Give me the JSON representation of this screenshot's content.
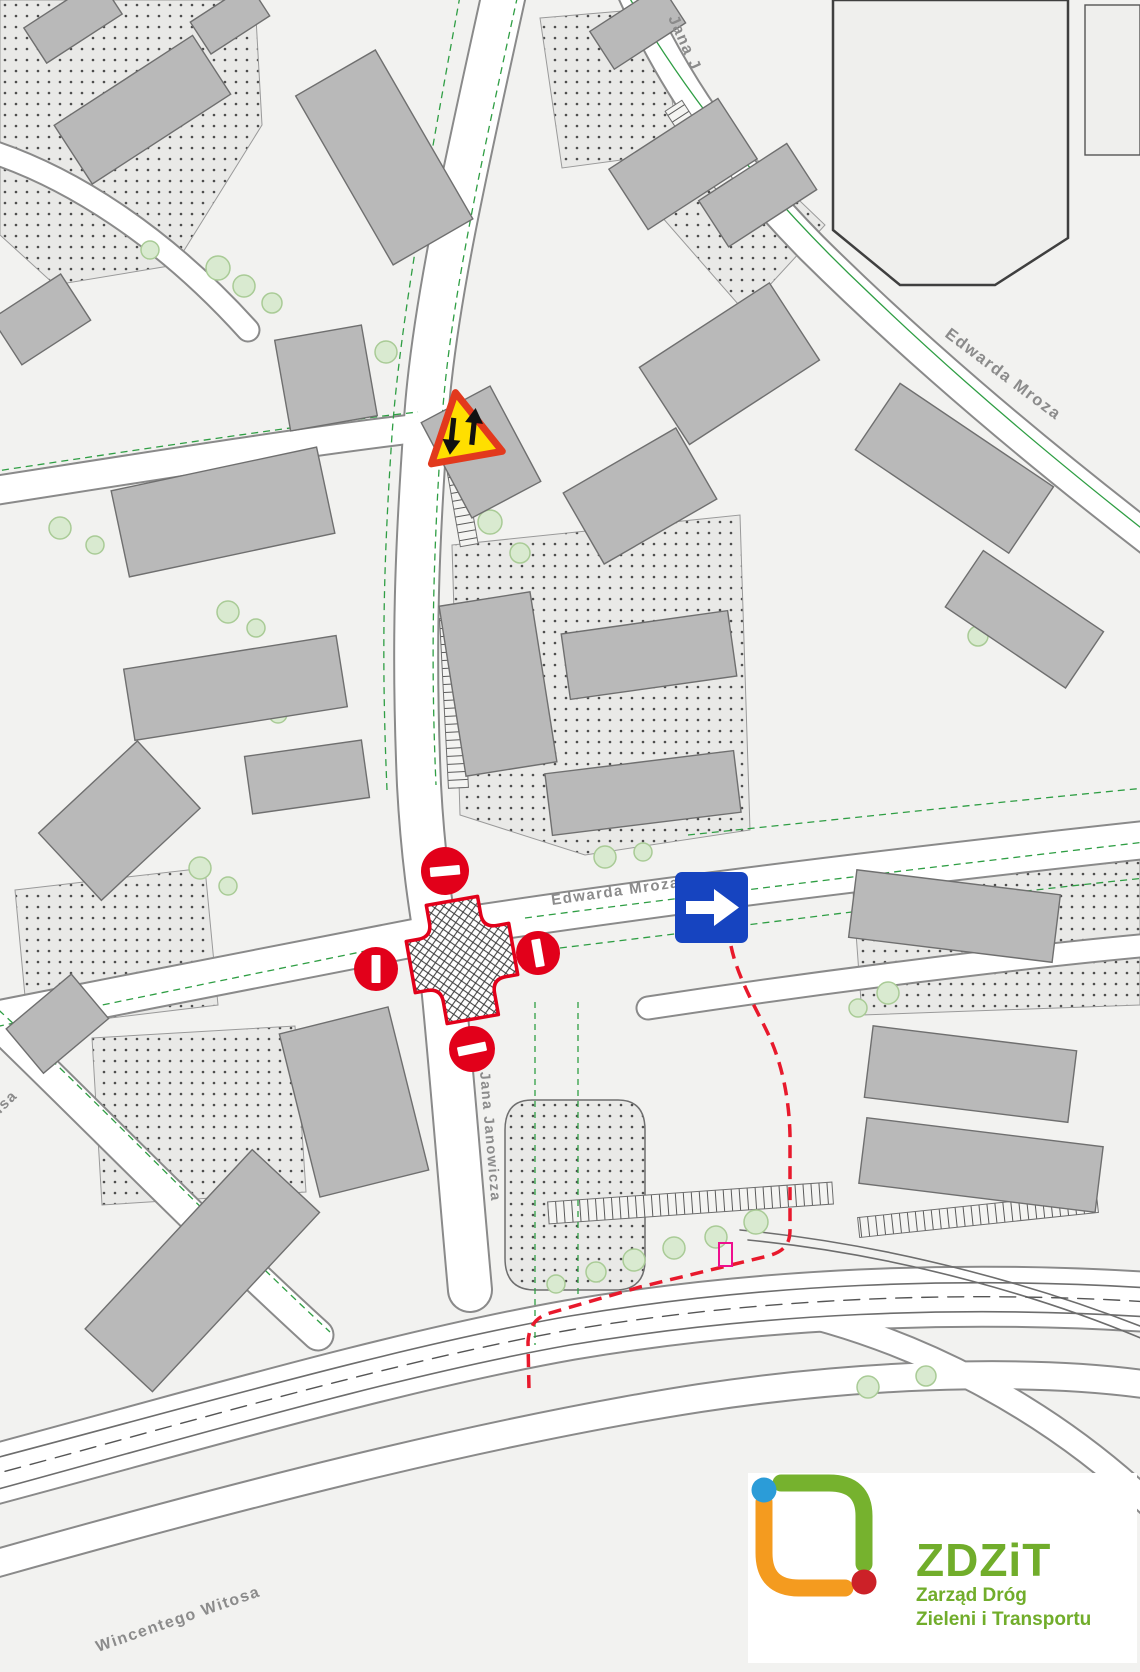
{
  "map": {
    "street_labels": [
      {
        "name": "jana-janowicza-north",
        "text": "Jana J"
      },
      {
        "name": "edwarda-mroza-northeast",
        "text": "Edwarda Mroza"
      },
      {
        "name": "edwarda-mroza-center",
        "text": "Edwarda Mroza"
      },
      {
        "name": "jana-janowicza-center",
        "text": "Jana Janowicza"
      },
      {
        "name": "wincentego-witosa",
        "text": "Wincentego Witosa"
      },
      {
        "name": "street-partial-west",
        "text": "lisa"
      }
    ]
  },
  "overlays": {
    "warning_sign": {
      "icon": "two-way-traffic-warning-icon",
      "shape": "triangle",
      "fill": "#ffdf00",
      "border": "#e2391d"
    },
    "no_entry_signs": {
      "icon": "no-entry-icon",
      "count": 4,
      "fill": "#e2001a",
      "bar": "#ffffff",
      "positions": [
        "north-of-intersection",
        "west-of-intersection",
        "east-of-intersection",
        "south-of-intersection"
      ]
    },
    "one_way_sign": {
      "icon": "one-way-right-arrow-icon",
      "fill": "#1644c0",
      "arrow": "#ffffff"
    },
    "closed_intersection": {
      "icon": "closed-intersection-crosshatch",
      "stroke": "#e2001a",
      "fill_pattern": "crosshatch"
    },
    "detour_route": {
      "style": "dashed",
      "color": "#e8192c"
    },
    "route_marker": {
      "icon": "gate-marker",
      "color": "#ef0f8e"
    }
  },
  "logo": {
    "abbr": "ZDZiT",
    "line1": "Zarząd Dróg",
    "line2": "Zieleni i Transportu",
    "text_color": "#71ad2b",
    "mark_colors": {
      "green": "#76b22e",
      "orange": "#f49b1f",
      "blue": "#2b9cd8",
      "red": "#cc2128"
    }
  }
}
